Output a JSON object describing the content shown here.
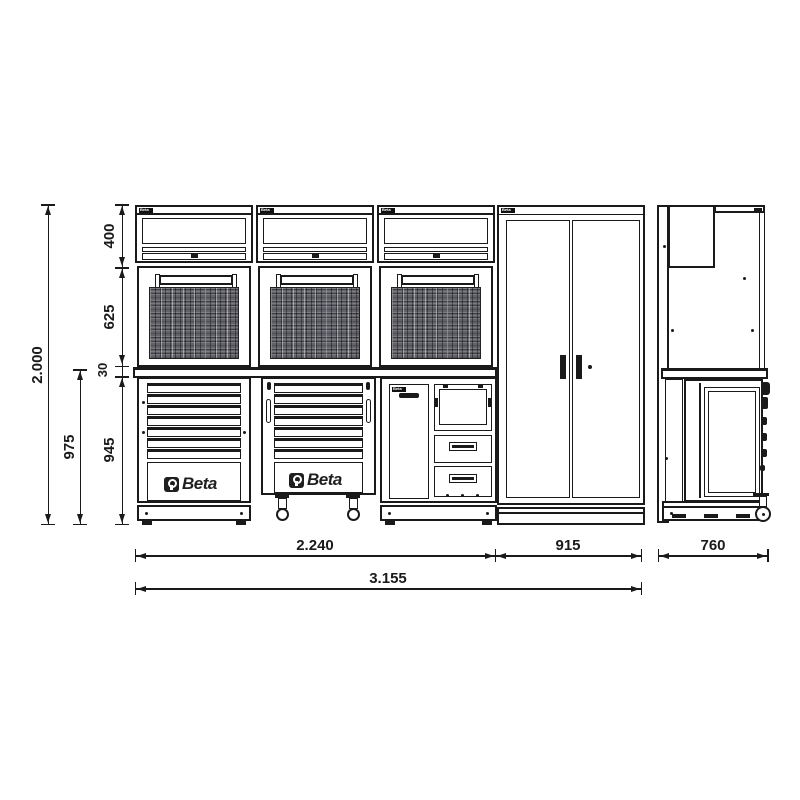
{
  "brand": "Beta",
  "dims": {
    "total_height": "2.000",
    "wall_unit_height": "400",
    "panel_height": "625",
    "worktop_thickness": "30",
    "base_unit_height": "945",
    "base_with_worktop_height": "975",
    "front_left_width": "2.240",
    "tall_cabinet_width": "915",
    "total_width": "3.155",
    "depth": "760"
  }
}
